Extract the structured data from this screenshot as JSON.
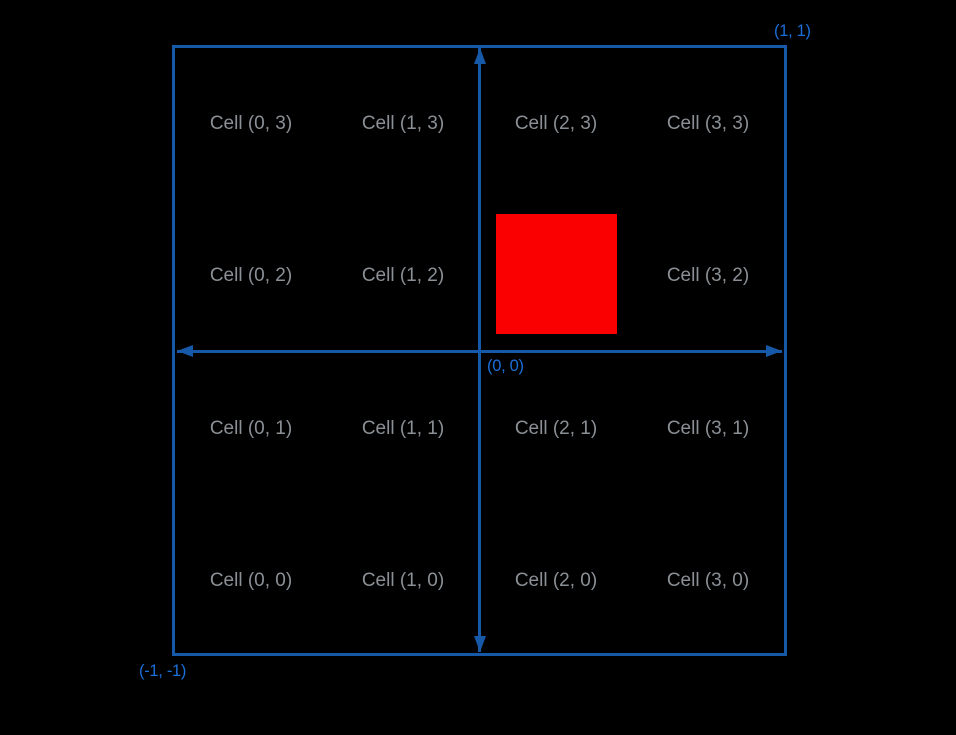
{
  "canvas": {
    "background": "#000000"
  },
  "colors": {
    "line_blue": "#1659a8",
    "coord_blue": "#1a6fd8",
    "cell_gray": "#8a9096",
    "highlight_red": "#fb0000",
    "bg": "#000000"
  },
  "coordinate_labels": {
    "top_right": "(1, 1)",
    "origin": "(0, 0)",
    "bottom_left": "(-1, -1)"
  },
  "grid": {
    "columns": 4,
    "rows": 4,
    "cell_labels": [
      {
        "col": 0,
        "row": 3,
        "label": "Cell (0, 3)"
      },
      {
        "col": 1,
        "row": 3,
        "label": "Cell (1, 3)"
      },
      {
        "col": 2,
        "row": 3,
        "label": "Cell (2, 3)"
      },
      {
        "col": 3,
        "row": 3,
        "label": "Cell (3, 3)"
      },
      {
        "col": 0,
        "row": 2,
        "label": "Cell (0, 2)"
      },
      {
        "col": 1,
        "row": 2,
        "label": "Cell (1, 2)"
      },
      {
        "col": 3,
        "row": 2,
        "label": "Cell (3, 2)"
      },
      {
        "col": 0,
        "row": 1,
        "label": "Cell (0, 1)"
      },
      {
        "col": 1,
        "row": 1,
        "label": "Cell (1, 1)"
      },
      {
        "col": 2,
        "row": 1,
        "label": "Cell (2, 1)"
      },
      {
        "col": 3,
        "row": 1,
        "label": "Cell (3, 1)"
      },
      {
        "col": 0,
        "row": 0,
        "label": "Cell (0, 0)"
      },
      {
        "col": 1,
        "row": 0,
        "label": "Cell (1, 0)"
      },
      {
        "col": 2,
        "row": 0,
        "label": "Cell (2, 0)"
      },
      {
        "col": 3,
        "row": 0,
        "label": "Cell (3, 0)"
      }
    ]
  },
  "highlight_square": {
    "cell": "(2, 2)",
    "color": "#fb0000"
  }
}
